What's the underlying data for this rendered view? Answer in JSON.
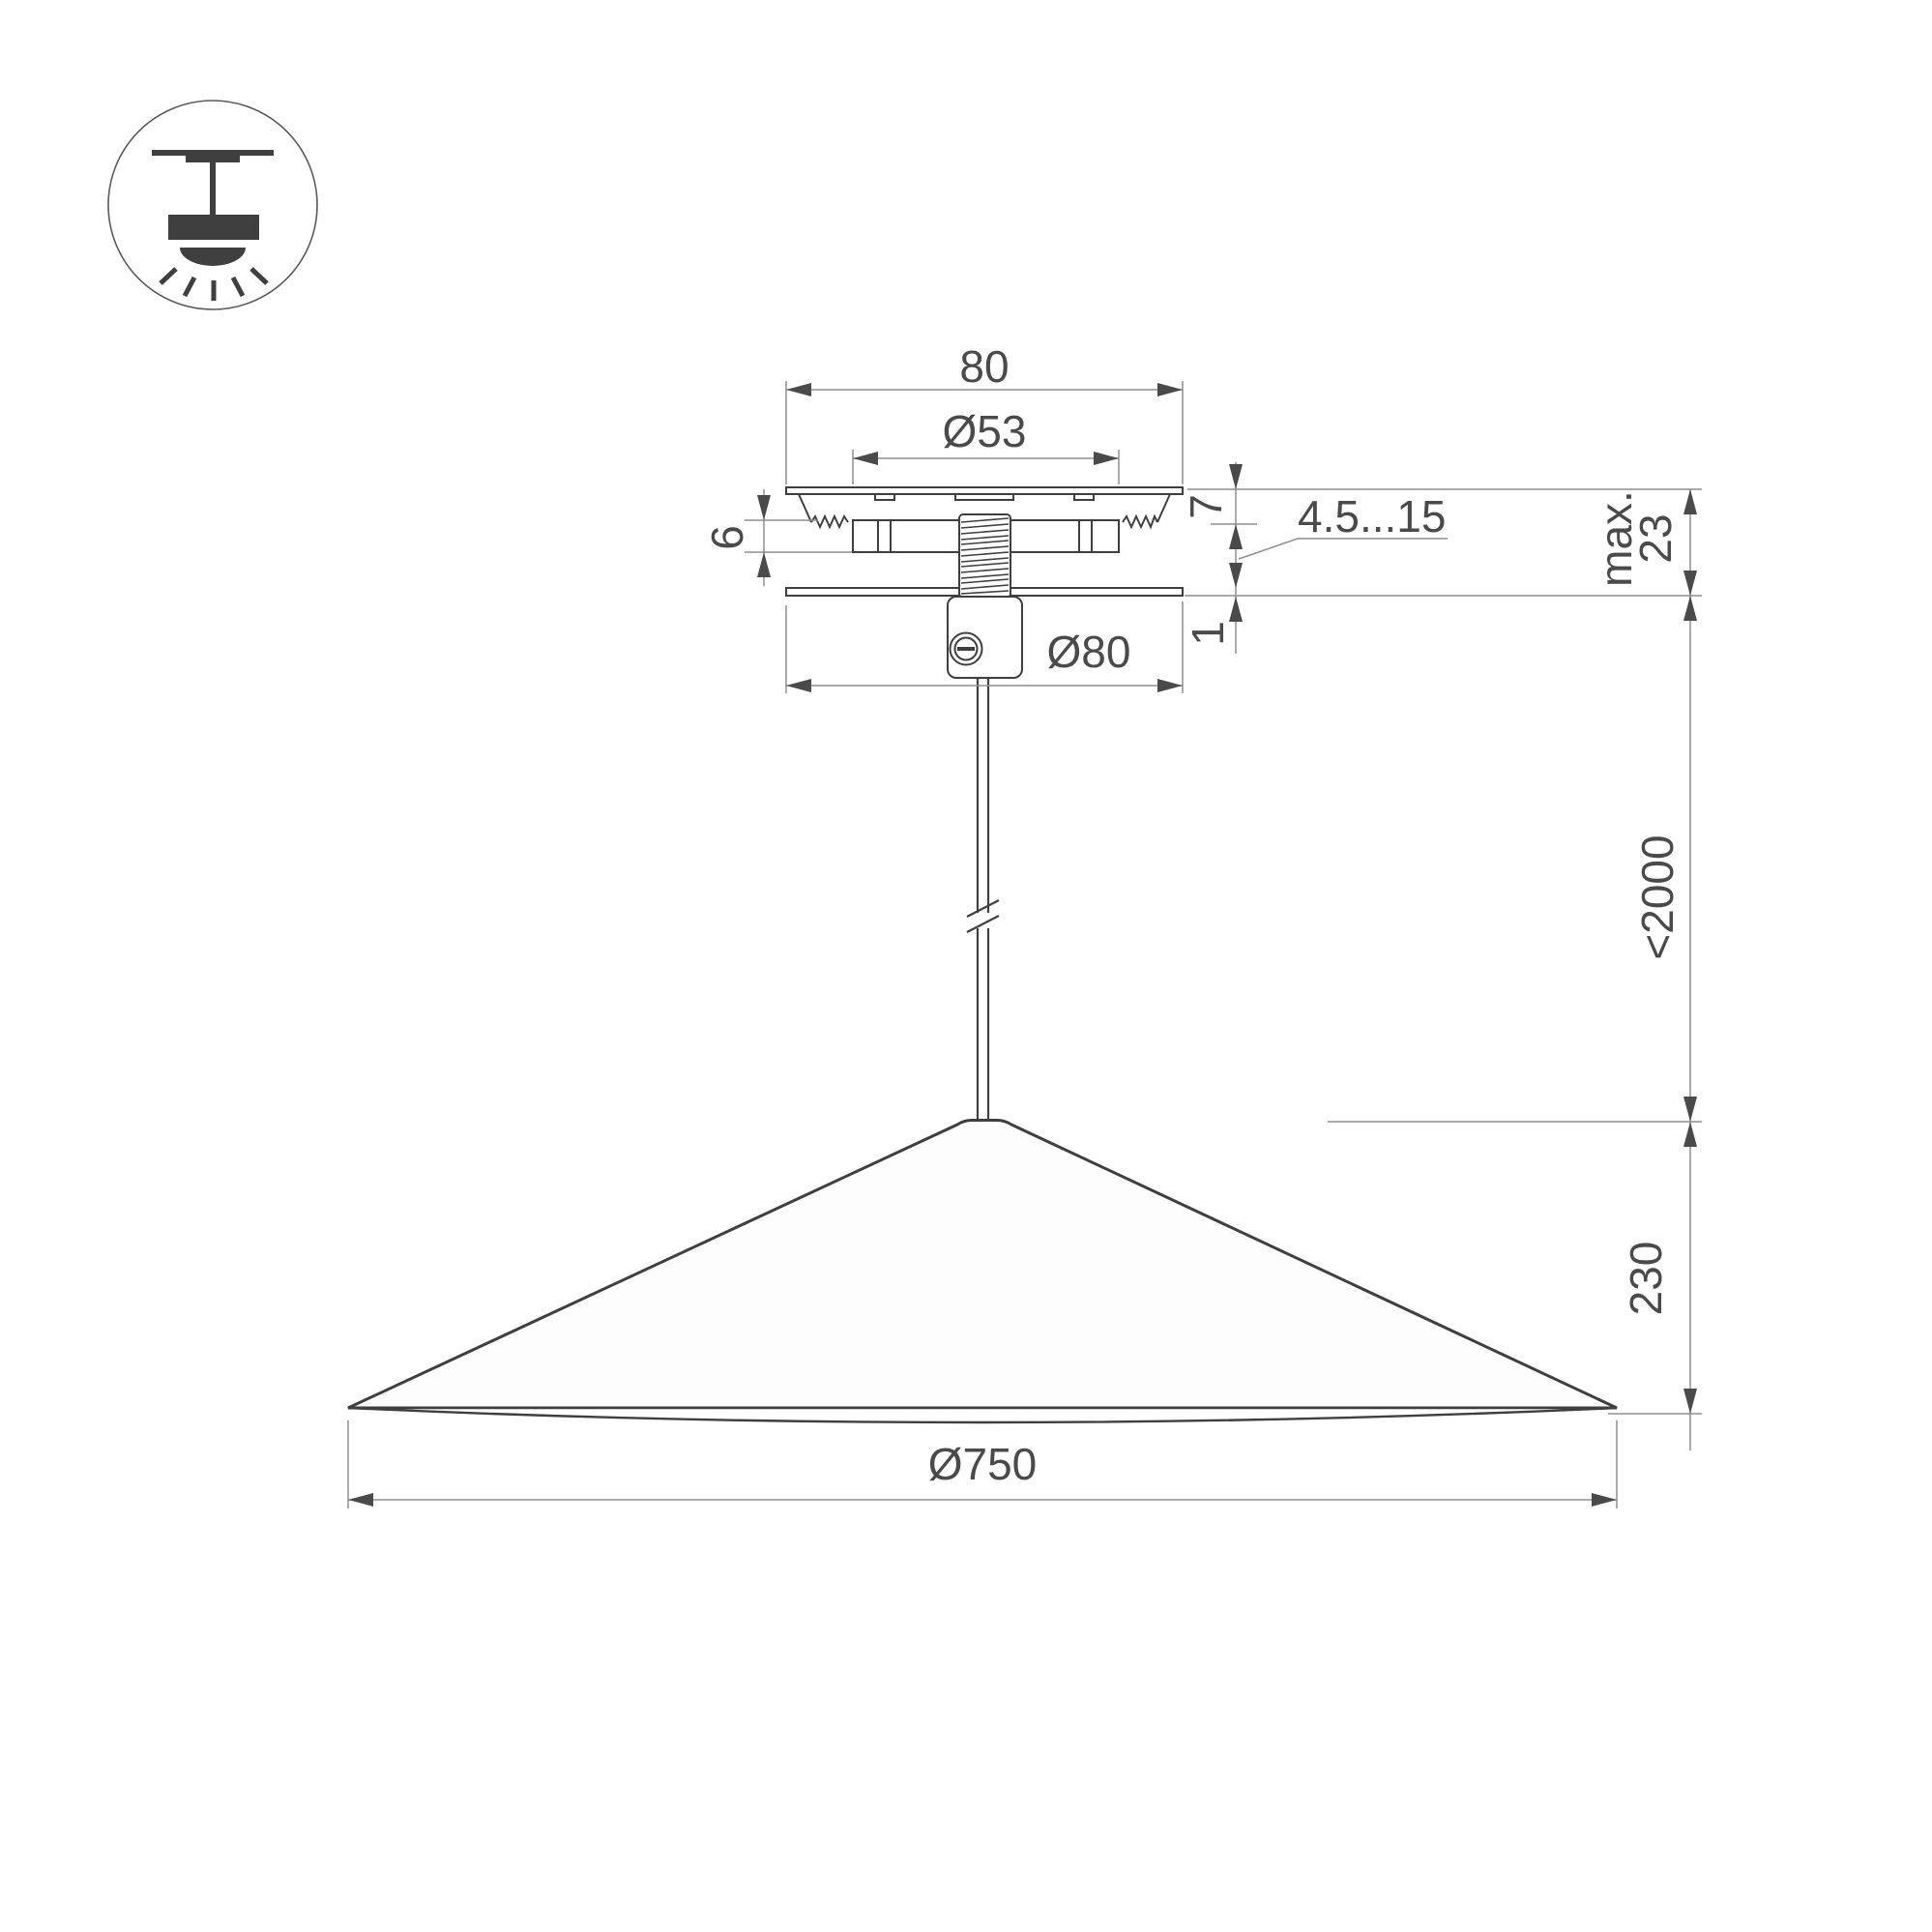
{
  "labels": {
    "canopy_width": "80",
    "canopy_ring_diameter": "Ø53",
    "plate_top_thickness": "7",
    "spring_clamp_height": "6",
    "ceiling_thickness_range": "4.5...15",
    "max_label": "max.",
    "max_canopy_depth": "23",
    "cover_plate_thickness": "1",
    "canopy_cover_diameter": "Ø80",
    "suspension_length": "<2000",
    "shade_height": "230",
    "shade_diameter": "Ø750"
  },
  "colors": {
    "line_dark": "#3f3f3f",
    "line_dim": "#8f8f8f",
    "text": "#4a4a4a",
    "background": "#ffffff"
  },
  "icons": [
    {
      "name": "pendant-ceiling-mount-icon",
      "meaning": "surface ceiling mounted pendant luminaire"
    }
  ]
}
